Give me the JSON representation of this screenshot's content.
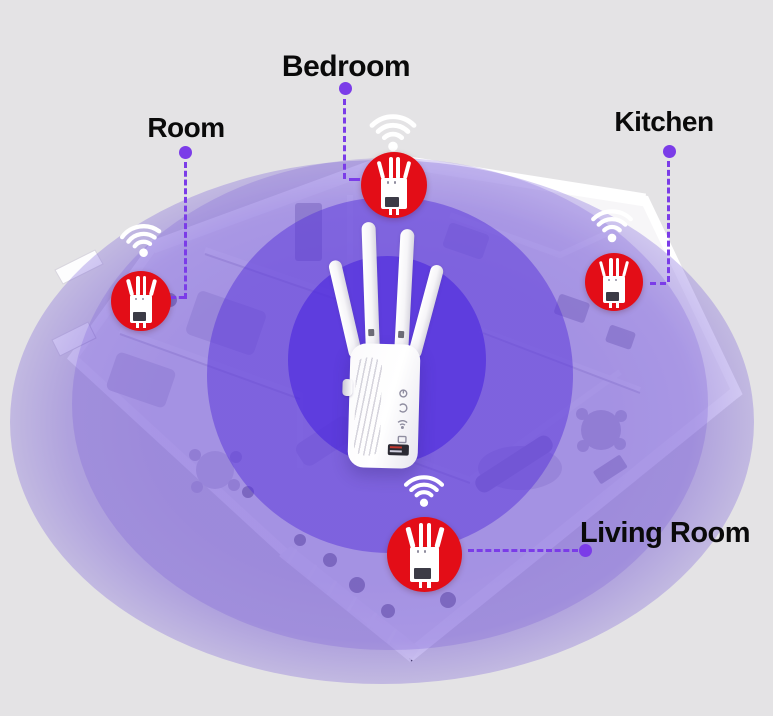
{
  "scene": {
    "type": "wifi-range-extender-coverage-diagram",
    "description": "isometric house floor plan with wifi repeater coverage rings"
  },
  "colors": {
    "background": "#e4e3e5",
    "accent_purple": "#7b3ce8",
    "badge_red": "#e30d17",
    "coverage_outer": "#ada2dd",
    "coverage_core": "#5b3be0",
    "label_text": "#0a0a0a",
    "device_white": "#ffffff"
  },
  "rooms": [
    {
      "id": "bedroom",
      "label": "Bedroom"
    },
    {
      "id": "room",
      "label": "Room"
    },
    {
      "id": "kitchen",
      "label": "Kitchen"
    },
    {
      "id": "living_room",
      "label": "Living Room"
    }
  ],
  "center_device": {
    "name": "wifi-repeater",
    "antenna_count": 4
  },
  "badges": {
    "name": "wifi-extender-badge",
    "count": 4
  },
  "wifi_icons": {
    "name": "wifi-signal-icon",
    "count": 4
  }
}
